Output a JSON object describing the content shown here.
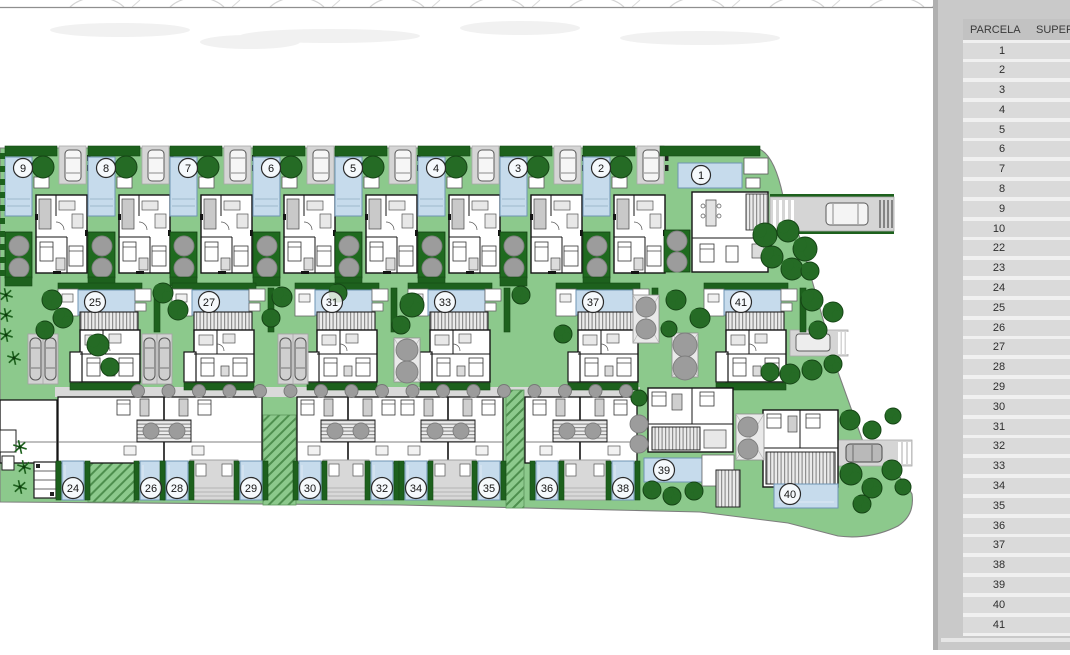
{
  "panel": {
    "table": {
      "header": {
        "parcela": "PARCELA",
        "superficie": "SUPERF"
      },
      "rows": [
        [
          "1",
          "466,"
        ],
        [
          "2",
          "305,"
        ],
        [
          "3",
          "305,"
        ],
        [
          "4",
          "306,"
        ],
        [
          "5",
          "307,"
        ],
        [
          "6",
          "307,"
        ],
        [
          "7",
          "308,"
        ],
        [
          "8",
          "308,"
        ],
        [
          "9",
          "309,"
        ],
        [
          "10",
          "309,"
        ],
        [
          "22",
          "304,"
        ],
        [
          "23",
          "334,"
        ],
        [
          "24",
          "152,"
        ],
        [
          "25",
          "333,"
        ],
        [
          "26",
          "153,"
        ],
        [
          "27",
          "333,"
        ],
        [
          "28",
          "153,"
        ],
        [
          "29",
          "153,"
        ],
        [
          "30",
          "154,"
        ],
        [
          "31",
          "333,"
        ],
        [
          "32",
          "154,"
        ],
        [
          "33",
          "333,"
        ],
        [
          "34",
          "154,"
        ],
        [
          "35",
          "155,"
        ],
        [
          "36",
          "155,"
        ],
        [
          "37",
          "429,"
        ],
        [
          "38",
          "156,"
        ],
        [
          "39",
          "330,"
        ],
        [
          "40",
          "644,"
        ],
        [
          "41",
          "500,"
        ]
      ]
    },
    "colors": {
      "panel_bg": "#c9c9c9",
      "row_bg": "#dadada",
      "header_bg": "#c2c2c2"
    }
  },
  "plan": {
    "colors": {
      "lawn": "#8cc98c",
      "hedge": "#1d611d",
      "tree": "#256b25",
      "tree_stroke": "#154415",
      "pool": "#c6dbec",
      "pool_stroke": "#6f94b5",
      "pavement": "#d5d5d5",
      "gray_tree": "#9c9c9c",
      "wall": "#141414",
      "boundary": "#7d7d7d"
    },
    "top_units": [
      {
        "n": "9",
        "cx": 23
      },
      {
        "n": "8",
        "cx": 106
      },
      {
        "n": "7",
        "cx": 188
      },
      {
        "n": "6",
        "cx": 271
      },
      {
        "n": "5",
        "cx": 353
      },
      {
        "n": "4",
        "cx": 436
      },
      {
        "n": "3",
        "cx": 518
      },
      {
        "n": "2",
        "cx": 601
      }
    ],
    "unit_one": {
      "n": "1",
      "cx": 701,
      "cy": 175
    },
    "mid_units": [
      {
        "n": "25",
        "cx": 95
      },
      {
        "n": "27",
        "cx": 209
      },
      {
        "n": "31",
        "cx": 332
      },
      {
        "n": "33",
        "cx": 445
      },
      {
        "n": "37",
        "cx": 593
      },
      {
        "n": "41",
        "cx": 741
      }
    ],
    "bottom_pools": [
      {
        "n": "24",
        "cx": 73
      },
      {
        "n": "26",
        "cx": 151
      },
      {
        "n": "28",
        "cx": 177
      },
      {
        "n": "29",
        "cx": 251
      },
      {
        "n": "30",
        "cx": 310
      },
      {
        "n": "32",
        "cx": 382
      },
      {
        "n": "34",
        "cx": 416
      },
      {
        "n": "35",
        "cx": 489
      },
      {
        "n": "36",
        "cx": 547
      },
      {
        "n": "38",
        "cx": 623
      }
    ],
    "parcel_39": {
      "n": "39",
      "cx": 664,
      "cy": 470
    },
    "parcel_40": {
      "n": "40",
      "cx": 790,
      "cy": 494
    },
    "bottom_buildings": {
      "segments": [
        [
          58,
          262
        ],
        [
          297,
          503
        ],
        [
          525,
          637
        ]
      ],
      "centers": [
        164,
        348,
        448,
        580
      ]
    },
    "ramps": [
      [
        88,
        425,
        50,
        77
      ],
      [
        263,
        415,
        33,
        90
      ],
      [
        506,
        390,
        18,
        118
      ]
    ],
    "street_trees": {
      "y": 391,
      "x0": 138,
      "x1": 628,
      "step": 30.5
    },
    "carports": [
      [
        28,
        334
      ],
      [
        142,
        334
      ],
      [
        278,
        334
      ]
    ],
    "trees_dark": [
      [
        765,
        235,
        12
      ],
      [
        788,
        231,
        11
      ],
      [
        805,
        249,
        12
      ],
      [
        772,
        257,
        11
      ],
      [
        792,
        269,
        11
      ],
      [
        810,
        271,
        9
      ],
      [
        676,
        300,
        10
      ],
      [
        700,
        318,
        10
      ],
      [
        669,
        329,
        8
      ],
      [
        812,
        300,
        11
      ],
      [
        833,
        312,
        10
      ],
      [
        818,
        330,
        9
      ],
      [
        770,
        372,
        9
      ],
      [
        790,
        374,
        10
      ],
      [
        812,
        370,
        10
      ],
      [
        833,
        364,
        9
      ],
      [
        563,
        334,
        9
      ],
      [
        52,
        300,
        10
      ],
      [
        63,
        318,
        10
      ],
      [
        45,
        330,
        9
      ],
      [
        98,
        345,
        11
      ],
      [
        110,
        367,
        9
      ],
      [
        163,
        293,
        10
      ],
      [
        178,
        310,
        10
      ],
      [
        282,
        297,
        10
      ],
      [
        271,
        318,
        9
      ],
      [
        412,
        305,
        12
      ],
      [
        401,
        325,
        9
      ],
      [
        338,
        293,
        9
      ],
      [
        521,
        295,
        9
      ],
      [
        639,
        398,
        8
      ],
      [
        652,
        490,
        9
      ],
      [
        672,
        496,
        9
      ],
      [
        694,
        491,
        9
      ],
      [
        850,
        420,
        10
      ],
      [
        872,
        430,
        9
      ],
      [
        893,
        416,
        8
      ],
      [
        851,
        474,
        11
      ],
      [
        872,
        488,
        10
      ],
      [
        892,
        470,
        10
      ],
      [
        903,
        487,
        8
      ],
      [
        862,
        504,
        9
      ]
    ],
    "gray_tree_squares": [
      [
        394,
        338,
        26,
        44
      ],
      [
        672,
        333,
        26,
        44
      ],
      [
        633,
        295,
        26,
        48
      ],
      [
        736,
        414,
        28,
        46
      ]
    ],
    "trees_gray": [
      [
        407,
        350,
        11
      ],
      [
        407,
        372,
        11
      ],
      [
        685,
        345,
        12
      ],
      [
        685,
        368,
        12
      ],
      [
        646,
        307,
        10
      ],
      [
        646,
        329,
        10
      ],
      [
        748,
        427,
        10
      ],
      [
        748,
        449,
        10
      ],
      [
        639,
        424,
        9
      ],
      [
        639,
        444,
        9
      ]
    ],
    "palms": [
      [
        20,
        447
      ],
      [
        24,
        467
      ],
      [
        20,
        487
      ],
      [
        6,
        295
      ],
      [
        6,
        315
      ],
      [
        6,
        335
      ],
      [
        14,
        358
      ]
    ]
  }
}
